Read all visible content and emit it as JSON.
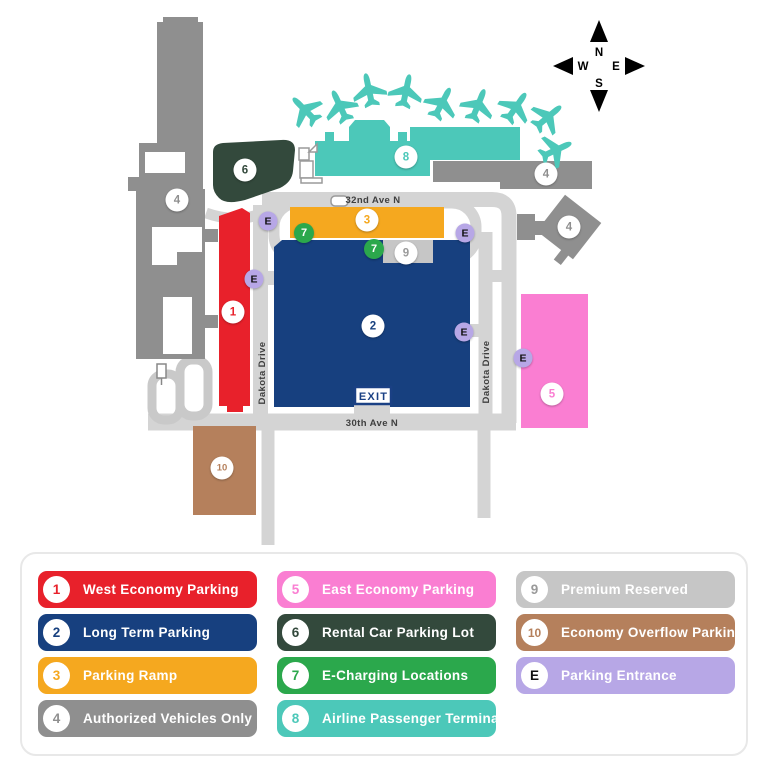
{
  "map": {
    "compass": {
      "north": "N",
      "south": "S",
      "east": "E",
      "west": "W"
    },
    "streets": {
      "ave_32": "32nd Ave N",
      "ave_30": "30th Ave N",
      "dakota_drive_west": "Dakota Drive",
      "dakota_drive_east": "Dakota Drive"
    },
    "exit_sign_label": "EXIT",
    "colors": {
      "west_economy": "#e8212b",
      "long_term": "#17407f",
      "parking_ramp": "#f5a81f",
      "authorized": "#8f8f8f",
      "east_economy": "#fa7ed2",
      "rental_car": "#33493c",
      "e_charging": "#2ba84c",
      "terminal": "#4cc8b9",
      "premium_reserved": "#c6c6c6",
      "economy_overflow": "#b5805c",
      "parking_entrance": "#b7a7e6",
      "road": "#d4d4d4",
      "building": "#8f8f8f"
    },
    "markers": [
      {
        "label": "1",
        "type": "lot",
        "x": 233,
        "y": 312,
        "bg": "#ffffff",
        "fg": "#e8212b"
      },
      {
        "label": "2",
        "type": "lot",
        "x": 373,
        "y": 326,
        "bg": "#ffffff",
        "fg": "#17407f"
      },
      {
        "label": "3",
        "type": "lot",
        "x": 367,
        "y": 220,
        "bg": "#ffffff",
        "fg": "#f5a81f"
      },
      {
        "label": "4",
        "type": "lot",
        "x": 177,
        "y": 200,
        "bg": "#ffffff",
        "fg": "#8f8f8f"
      },
      {
        "label": "4",
        "type": "lot",
        "x": 546,
        "y": 174,
        "bg": "#ffffff",
        "fg": "#8f8f8f"
      },
      {
        "label": "4",
        "type": "lot",
        "x": 569,
        "y": 227,
        "bg": "#ffffff",
        "fg": "#8f8f8f"
      },
      {
        "label": "5",
        "type": "lot",
        "x": 552,
        "y": 394,
        "bg": "#ffffff",
        "fg": "#fa7ed2"
      },
      {
        "label": "6",
        "type": "lot",
        "x": 245,
        "y": 170,
        "bg": "#ffffff",
        "fg": "#33493c"
      },
      {
        "label": "8",
        "type": "lot",
        "x": 406,
        "y": 157,
        "bg": "#ffffff",
        "fg": "#4cc8b9"
      },
      {
        "label": "9",
        "type": "lot",
        "x": 406,
        "y": 253,
        "bg": "#ffffff",
        "fg": "#9a9a9a"
      },
      {
        "label": "10",
        "type": "lot",
        "x": 222,
        "y": 468,
        "bg": "#ffffff",
        "fg": "#b5805c"
      },
      {
        "label": "7",
        "type": "charging",
        "x": 304,
        "y": 233,
        "bg": "#2ba84c",
        "fg": "#ffffff"
      },
      {
        "label": "7",
        "type": "charging",
        "x": 374,
        "y": 249,
        "bg": "#2ba84c",
        "fg": "#ffffff"
      },
      {
        "label": "E",
        "type": "entrance",
        "x": 268,
        "y": 221,
        "bg": "#b7a7e6",
        "fg": "#111111"
      },
      {
        "label": "E",
        "type": "entrance",
        "x": 465,
        "y": 233,
        "bg": "#b7a7e6",
        "fg": "#111111"
      },
      {
        "label": "E",
        "type": "entrance",
        "x": 254,
        "y": 279,
        "bg": "#b7a7e6",
        "fg": "#111111"
      },
      {
        "label": "E",
        "type": "entrance",
        "x": 464,
        "y": 332,
        "bg": "#b7a7e6",
        "fg": "#111111"
      },
      {
        "label": "E",
        "type": "entrance",
        "x": 523,
        "y": 358,
        "bg": "#b7a7e6",
        "fg": "#111111"
      }
    ]
  },
  "legend": {
    "columns": [
      [
        {
          "badge": "1",
          "label": "West Economy Parking",
          "color": "#e8212b",
          "badge_text": "#e8212b",
          "text": "#ffffff"
        },
        {
          "badge": "2",
          "label": "Long Term Parking",
          "color": "#17407f",
          "badge_text": "#17407f",
          "text": "#ffffff"
        },
        {
          "badge": "3",
          "label": "Parking Ramp",
          "color": "#f5a81f",
          "badge_text": "#f5a81f",
          "text": "#ffffff"
        },
        {
          "badge": "4",
          "label": "Authorized Vehicles Only",
          "color": "#8f8f8f",
          "badge_text": "#8f8f8f",
          "text": "#ffffff"
        }
      ],
      [
        {
          "badge": "5",
          "label": "East Economy Parking",
          "color": "#fa7ed2",
          "badge_text": "#fa7ed2",
          "text": "#ffffff"
        },
        {
          "badge": "6",
          "label": "Rental Car Parking Lot",
          "color": "#33493c",
          "badge_text": "#33493c",
          "text": "#ffffff"
        },
        {
          "badge": "7",
          "label": "E-Charging Locations",
          "color": "#2ba84c",
          "badge_text": "#2ba84c",
          "text": "#ffffff"
        },
        {
          "badge": "8",
          "label": "Airline Passenger Terminal",
          "color": "#4cc8b9",
          "badge_text": "#4cc8b9",
          "text": "#ffffff"
        }
      ],
      [
        {
          "badge": "9",
          "label": "Premium Reserved",
          "color": "#c6c6c6",
          "badge_text": "#9a9a9a",
          "text": "#ffffff"
        },
        {
          "badge": "10",
          "label": "Economy Overflow Parking",
          "color": "#b5805c",
          "badge_text": "#b5805c",
          "text": "#ffffff"
        },
        {
          "badge": "E",
          "label": "Parking Entrance",
          "color": "#b7a7e6",
          "badge_text": "#111111",
          "text": "#ffffff"
        }
      ]
    ]
  }
}
